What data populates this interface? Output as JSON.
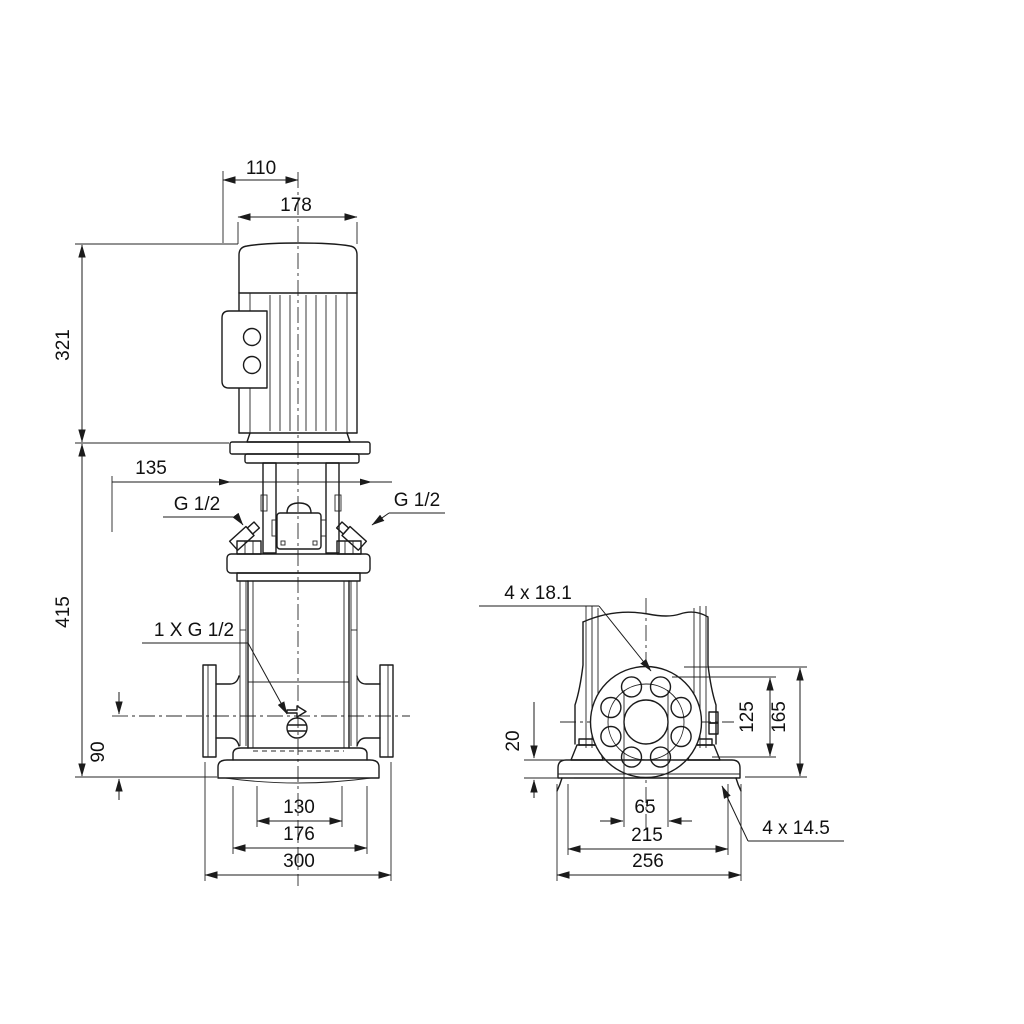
{
  "drawing": {
    "kind": "pump-dimensional-drawing",
    "units_implied": "mm",
    "front_view": {
      "dim_top_width": "110",
      "dim_motor_width": "178",
      "dim_motor_height": "321",
      "dim_head_width": "135",
      "dim_pump_height": "415",
      "dim_port_height": "90",
      "dim_base_holes": "130",
      "dim_base_width": "176",
      "dim_flange_span": "300",
      "label_vent_left": "G 1/2",
      "label_vent_right": "G 1/2",
      "label_drain": "1 X G 1/2"
    },
    "side_view": {
      "label_flange_holes": "4 x 18.1",
      "dim_base_thickness": "20",
      "dim_port_center_height": "125",
      "dim_flange_top_height": "165",
      "dim_bore": "65",
      "dim_base_hole_span": "215",
      "dim_base_plate_width": "256",
      "label_base_holes": "4 x 14.5"
    }
  }
}
